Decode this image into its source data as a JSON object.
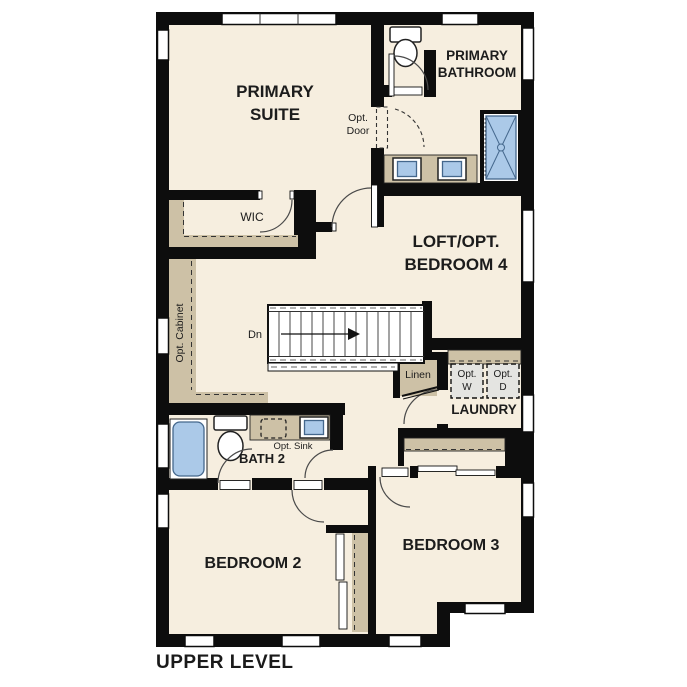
{
  "plan_title": "UPPER LEVEL",
  "rooms": {
    "primary_suite": {
      "line1": "PRIMARY",
      "line2": "SUITE"
    },
    "primary_bathroom": {
      "line1": "PRIMARY",
      "line2": "BATHROOM"
    },
    "wic": {
      "label": "WIC"
    },
    "loft_bedroom4": {
      "line1": "LOFT/OPT.",
      "line2": "BEDROOM 4"
    },
    "laundry": {
      "label": "LAUNDRY"
    },
    "bath2": {
      "label": "BATH 2"
    },
    "bedroom2": {
      "label": "BEDROOM 2"
    },
    "bedroom3": {
      "label": "BEDROOM 3"
    }
  },
  "annotations": {
    "opt_door": {
      "line1": "Opt.",
      "line2": "Door"
    },
    "opt_cabinet": "Opt. Cabinet",
    "stair_direction": "Dn",
    "linen": "Linen",
    "opt_washer": {
      "line1": "Opt.",
      "line2": "W"
    },
    "opt_dryer": {
      "line1": "Opt.",
      "line2": "D"
    },
    "opt_sink": "Opt. Sink"
  },
  "colors": {
    "wall": "#0d0d0d",
    "floor": "#f6eedf",
    "casework": "#cdc1a6",
    "fixture_blue": "#abc9e8",
    "appliance_gray": "#e4e4e1",
    "background": "#ffffff"
  }
}
